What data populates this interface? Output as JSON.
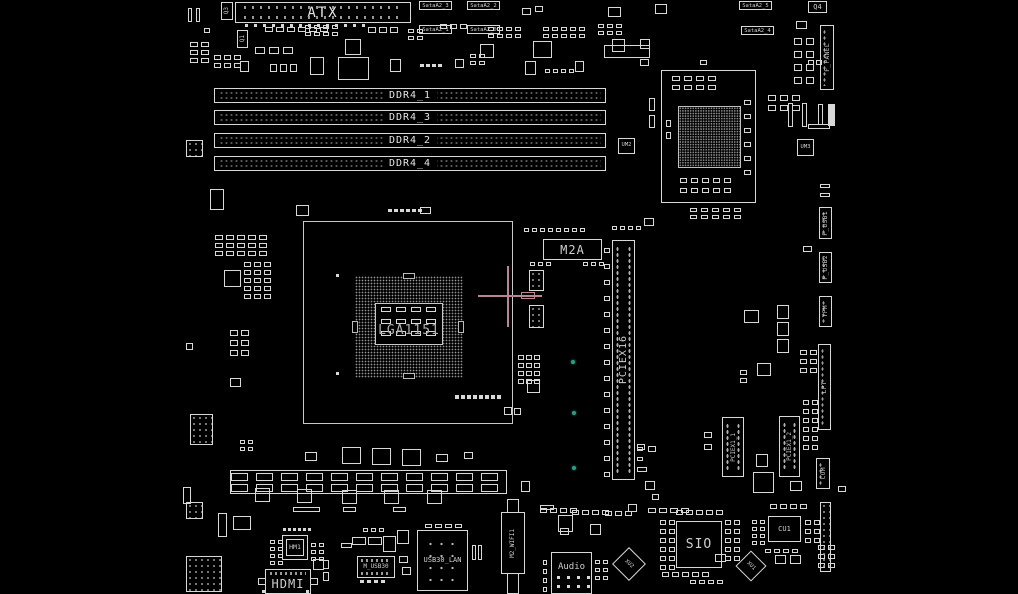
{
  "app": {
    "view": "pcb-boardview",
    "background": "#000000",
    "trace_color": "#d8d8d8",
    "dim_color": "#9a9a9a",
    "label_color": "#cfcfcf",
    "crosshair_color": "#bb8495",
    "testpoint_color": "#2e9a82"
  },
  "labels": {
    "atx": "ATX",
    "cpu_socket": "LGA1151",
    "m2a": "M2A",
    "pciex16": "PCIEX16",
    "pciex1_1": "PCIEX1_1",
    "pciex1_2": "PCIEX1_2",
    "sio": "SIO",
    "audio": "Audio",
    "hdmi": "HDMI",
    "hm1": "HM1",
    "usb30_lan": "USB30_LAN",
    "m_usb30": "M_USB30",
    "m2_wifi": "M2_WIFI1",
    "cu1": "CU1",
    "um2": "UM2",
    "um3": "UM3",
    "q4": "Q4",
    "q3": "Q3",
    "q1": "Q1",
    "xu1": "XU1",
    "xu2": "XU2"
  },
  "ddr_slots": [
    {
      "label": "DDR4_1",
      "y": 88
    },
    {
      "label": "DDR4_3",
      "y": 110
    },
    {
      "label": "DDR4_2",
      "y": 133
    },
    {
      "label": "DDR4_4",
      "y": 156
    }
  ],
  "edge_connectors": [
    {
      "label": "F_PANEL",
      "x": 820,
      "y": 25,
      "w": 14,
      "h": 65
    },
    {
      "label": "F_USB1",
      "x": 819,
      "y": 207,
      "w": 13,
      "h": 32
    },
    {
      "label": "F_USB2",
      "x": 819,
      "y": 252,
      "w": 13,
      "h": 31
    },
    {
      "label": "TPM",
      "x": 819,
      "y": 296,
      "w": 13,
      "h": 31
    },
    {
      "label": "LPT",
      "x": 818,
      "y": 344,
      "w": 13,
      "h": 86
    },
    {
      "label": "COM",
      "x": 816,
      "y": 458,
      "w": 14,
      "h": 31
    }
  ],
  "sata_labels": [
    {
      "text": "SataA2_3",
      "x": 419,
      "y": 1
    },
    {
      "text": "SataA2_2",
      "x": 467,
      "y": 1
    },
    {
      "text": "SataA2_1",
      "x": 419,
      "y": 25
    },
    {
      "text": "SataA2_0",
      "x": 467,
      "y": 25
    },
    {
      "text": "SataA2_5",
      "x": 739,
      "y": 1
    },
    {
      "text": "SataA2_4",
      "x": 741,
      "y": 26
    }
  ],
  "testpoints": [
    {
      "x": 571,
      "y": 360
    },
    {
      "x": 572,
      "y": 411
    },
    {
      "x": 572,
      "y": 466
    }
  ],
  "crosshair": {
    "center_x": 508,
    "center_y": 296
  },
  "clusters": [
    [
      190,
      42,
      2,
      3,
      8,
      5,
      3,
      3
    ],
    [
      188,
      8,
      2,
      1,
      4,
      14,
      4,
      0
    ],
    [
      214,
      55,
      3,
      2,
      7,
      5,
      3,
      3
    ],
    [
      265,
      27,
      6,
      1,
      8,
      5,
      3,
      0
    ],
    [
      305,
      25,
      4,
      2,
      6,
      4,
      3,
      3
    ],
    [
      368,
      27,
      3,
      1,
      8,
      6,
      3,
      0
    ],
    [
      408,
      29,
      2,
      2,
      6,
      4,
      3,
      3
    ],
    [
      440,
      24,
      3,
      1,
      7,
      5,
      3,
      0
    ],
    [
      488,
      27,
      4,
      2,
      6,
      4,
      3,
      3
    ],
    [
      543,
      27,
      5,
      2,
      6,
      4,
      3,
      3
    ],
    [
      598,
      24,
      3,
      2,
      6,
      4,
      3,
      3
    ],
    [
      255,
      47,
      3,
      1,
      10,
      7,
      4,
      0
    ],
    [
      420,
      64,
      4,
      1,
      4,
      3,
      2,
      0
    ],
    [
      470,
      54,
      2,
      2,
      6,
      4,
      3,
      3
    ],
    [
      545,
      69,
      4,
      1,
      5,
      4,
      3,
      0
    ],
    [
      245,
      24,
      14,
      1,
      3,
      3,
      6,
      0
    ],
    [
      215,
      235,
      5,
      3,
      8,
      5,
      3,
      3
    ],
    [
      244,
      262,
      3,
      5,
      7,
      5,
      3,
      3
    ],
    [
      230,
      330,
      2,
      3,
      8,
      6,
      3,
      4
    ],
    [
      240,
      440,
      2,
      2,
      5,
      4,
      3,
      3
    ],
    [
      388,
      209,
      6,
      1,
      4,
      3,
      2,
      0
    ],
    [
      524,
      228,
      8,
      1,
      5,
      4,
      3,
      0
    ],
    [
      530,
      262,
      3,
      1,
      5,
      4,
      3,
      0
    ],
    [
      583,
      262,
      3,
      1,
      5,
      4,
      3,
      0
    ],
    [
      604,
      248,
      1,
      15,
      6,
      5,
      0,
      11
    ],
    [
      518,
      355,
      3,
      4,
      6,
      5,
      2,
      3
    ],
    [
      612,
      226,
      4,
      1,
      5,
      4,
      3,
      0
    ],
    [
      672,
      76,
      4,
      2,
      8,
      5,
      4,
      4
    ],
    [
      744,
      100,
      1,
      6,
      7,
      5,
      0,
      9
    ],
    [
      680,
      178,
      5,
      2,
      7,
      5,
      4,
      5
    ],
    [
      690,
      208,
      5,
      2,
      7,
      4,
      4,
      3
    ],
    [
      768,
      95,
      3,
      2,
      8,
      6,
      4,
      4
    ],
    [
      800,
      350,
      2,
      3,
      7,
      5,
      3,
      4
    ],
    [
      794,
      38,
      2,
      4,
      8,
      7,
      4,
      6
    ],
    [
      818,
      545,
      2,
      3,
      7,
      5,
      3,
      4
    ],
    [
      648,
      508,
      4,
      1,
      8,
      5,
      3,
      0
    ],
    [
      676,
      510,
      5,
      1,
      7,
      5,
      3,
      0
    ],
    [
      660,
      520,
      2,
      6,
      6,
      5,
      3,
      4
    ],
    [
      725,
      520,
      2,
      5,
      6,
      5,
      3,
      4
    ],
    [
      662,
      572,
      5,
      1,
      7,
      5,
      3,
      0
    ],
    [
      690,
      580,
      4,
      1,
      6,
      4,
      3,
      0
    ],
    [
      752,
      520,
      2,
      4,
      5,
      4,
      3,
      3
    ],
    [
      770,
      504,
      4,
      1,
      7,
      5,
      3,
      0
    ],
    [
      805,
      520,
      2,
      3,
      6,
      5,
      3,
      4
    ],
    [
      765,
      549,
      4,
      1,
      6,
      4,
      3,
      0
    ],
    [
      543,
      560,
      1,
      4,
      4,
      5,
      0,
      4
    ],
    [
      595,
      560,
      2,
      3,
      5,
      4,
      3,
      4
    ],
    [
      425,
      524,
      4,
      1,
      7,
      4,
      3,
      0
    ],
    [
      363,
      528,
      3,
      1,
      5,
      4,
      3,
      0
    ],
    [
      270,
      540,
      2,
      4,
      5,
      4,
      3,
      3
    ],
    [
      311,
      543,
      2,
      3,
      5,
      4,
      3,
      3
    ],
    [
      283,
      528,
      6,
      1,
      3,
      3,
      2,
      0
    ],
    [
      704,
      432,
      1,
      2,
      8,
      6,
      0,
      6
    ],
    [
      803,
      400,
      2,
      6,
      6,
      5,
      3,
      4
    ],
    [
      231,
      473,
      11,
      1,
      17,
      8,
      8,
      0
    ],
    [
      231,
      484,
      11,
      1,
      17,
      8,
      8,
      0
    ],
    [
      381,
      307,
      4,
      1,
      10,
      5,
      5,
      0
    ],
    [
      381,
      319,
      4,
      1,
      10,
      5,
      5,
      0
    ],
    [
      381,
      331,
      4,
      1,
      10,
      5,
      5,
      0
    ],
    [
      455,
      395,
      8,
      1,
      4,
      4,
      2,
      0
    ],
    [
      540,
      508,
      4,
      1,
      7,
      5,
      3,
      0
    ],
    [
      572,
      510,
      4,
      1,
      7,
      5,
      3,
      0
    ],
    [
      605,
      511,
      3,
      1,
      7,
      5,
      3,
      0
    ],
    [
      557,
      576,
      4,
      2,
      3,
      3,
      7,
      6
    ],
    [
      360,
      580,
      4,
      1,
      4,
      3,
      3,
      0
    ],
    [
      637,
      447,
      1,
      2,
      6,
      4,
      0,
      6
    ]
  ],
  "parts": [
    [
      345,
      39,
      16,
      16,
      "o"
    ],
    [
      480,
      44,
      14,
      14,
      "o"
    ],
    [
      533,
      41,
      19,
      17,
      "o"
    ],
    [
      604,
      45,
      46,
      13,
      "o"
    ],
    [
      338,
      57,
      31,
      23,
      "o"
    ],
    [
      240,
      61,
      9,
      11,
      "o"
    ],
    [
      270,
      64,
      7,
      8,
      "o"
    ],
    [
      280,
      64,
      7,
      8,
      "o"
    ],
    [
      290,
      64,
      7,
      8,
      "o"
    ],
    [
      310,
      57,
      14,
      18,
      "o"
    ],
    [
      390,
      59,
      11,
      13,
      "o"
    ],
    [
      455,
      59,
      9,
      9,
      "o"
    ],
    [
      525,
      61,
      11,
      14,
      "o"
    ],
    [
      575,
      61,
      9,
      11,
      "o"
    ],
    [
      608,
      7,
      13,
      10,
      "o"
    ],
    [
      655,
      4,
      12,
      10,
      "o"
    ],
    [
      612,
      39,
      13,
      13,
      "o"
    ],
    [
      640,
      39,
      10,
      10,
      "o"
    ],
    [
      186,
      140,
      17,
      17,
      "d"
    ],
    [
      210,
      189,
      14,
      21,
      "o"
    ],
    [
      224,
      270,
      17,
      17,
      "o"
    ],
    [
      190,
      414,
      23,
      31,
      "d"
    ],
    [
      230,
      378,
      11,
      9,
      "o"
    ],
    [
      186,
      343,
      7,
      7,
      "o"
    ],
    [
      342,
      447,
      19,
      17,
      "o"
    ],
    [
      372,
      448,
      19,
      17,
      "o"
    ],
    [
      402,
      449,
      19,
      17,
      "o"
    ],
    [
      305,
      452,
      12,
      9,
      "o"
    ],
    [
      529,
      270,
      15,
      21,
      "d"
    ],
    [
      529,
      305,
      15,
      23,
      "d"
    ],
    [
      527,
      380,
      13,
      13,
      "o"
    ],
    [
      649,
      98,
      6,
      13,
      "o"
    ],
    [
      649,
      115,
      6,
      13,
      "o"
    ],
    [
      788,
      103,
      5,
      24,
      "o"
    ],
    [
      802,
      103,
      5,
      24,
      "o"
    ],
    [
      818,
      104,
      5,
      21,
      "o"
    ],
    [
      808,
      124,
      22,
      5,
      "o"
    ],
    [
      828,
      104,
      7,
      22,
      "f"
    ],
    [
      777,
      305,
      12,
      14,
      "o"
    ],
    [
      777,
      322,
      12,
      14,
      "o"
    ],
    [
      777,
      339,
      12,
      14,
      "o"
    ],
    [
      803,
      246,
      9,
      6,
      "o"
    ],
    [
      820,
      184,
      10,
      4,
      "o"
    ],
    [
      820,
      193,
      10,
      4,
      "o"
    ],
    [
      753,
      472,
      21,
      21,
      "o"
    ],
    [
      756,
      454,
      12,
      13,
      "o"
    ],
    [
      744,
      310,
      15,
      13,
      "o"
    ],
    [
      757,
      363,
      14,
      13,
      "o"
    ],
    [
      740,
      370,
      7,
      5,
      "o"
    ],
    [
      740,
      378,
      7,
      5,
      "o"
    ],
    [
      644,
      218,
      10,
      8,
      "o"
    ],
    [
      186,
      502,
      17,
      17,
      "d"
    ],
    [
      186,
      556,
      36,
      36,
      "d"
    ],
    [
      218,
      513,
      9,
      24,
      "o"
    ],
    [
      233,
      516,
      18,
      14,
      "o"
    ],
    [
      293,
      507,
      27,
      5,
      "o"
    ],
    [
      343,
      507,
      13,
      5,
      "o"
    ],
    [
      393,
      507,
      13,
      5,
      "o"
    ],
    [
      313,
      559,
      11,
      11,
      "o"
    ],
    [
      352,
      537,
      14,
      8,
      "o"
    ],
    [
      368,
      537,
      14,
      8,
      "o"
    ],
    [
      383,
      536,
      13,
      16,
      "o"
    ],
    [
      341,
      543,
      11,
      5,
      "o"
    ],
    [
      399,
      556,
      9,
      7,
      "o"
    ],
    [
      402,
      567,
      9,
      8,
      "o"
    ],
    [
      472,
      545,
      4,
      15,
      "o"
    ],
    [
      478,
      545,
      4,
      15,
      "o"
    ],
    [
      558,
      515,
      15,
      17,
      "o"
    ],
    [
      540,
      505,
      14,
      5,
      "o"
    ],
    [
      560,
      528,
      9,
      7,
      "o"
    ],
    [
      590,
      524,
      11,
      11,
      "o"
    ],
    [
      715,
      554,
      11,
      8,
      "o"
    ],
    [
      775,
      555,
      11,
      9,
      "o"
    ],
    [
      790,
      555,
      11,
      9,
      "o"
    ],
    [
      820,
      502,
      11,
      70,
      "d"
    ],
    [
      296,
      205,
      13,
      11,
      "o"
    ],
    [
      420,
      207,
      11,
      7,
      "o"
    ],
    [
      666,
      120,
      5,
      7,
      "o"
    ],
    [
      666,
      132,
      5,
      7,
      "o"
    ],
    [
      640,
      59,
      9,
      7,
      "o"
    ],
    [
      700,
      60,
      7,
      5,
      "o"
    ],
    [
      796,
      21,
      11,
      8,
      "o"
    ],
    [
      808,
      60,
      6,
      5,
      "o"
    ],
    [
      816,
      60,
      6,
      5,
      "o"
    ],
    [
      183,
      487,
      8,
      17,
      "o"
    ],
    [
      255,
      488,
      15,
      14,
      "o"
    ],
    [
      297,
      489,
      15,
      14,
      "o"
    ],
    [
      342,
      490,
      15,
      14,
      "o"
    ],
    [
      384,
      490,
      15,
      14,
      "o"
    ],
    [
      427,
      490,
      15,
      14,
      "o"
    ],
    [
      436,
      454,
      12,
      8,
      "o"
    ],
    [
      464,
      452,
      9,
      7,
      "o"
    ],
    [
      504,
      407,
      8,
      8,
      "o"
    ],
    [
      514,
      408,
      7,
      7,
      "o"
    ],
    [
      336,
      274,
      3,
      3,
      "f"
    ],
    [
      336,
      372,
      3,
      3,
      "f"
    ],
    [
      521,
      481,
      9,
      11,
      "o"
    ],
    [
      645,
      481,
      10,
      9,
      "o"
    ],
    [
      652,
      494,
      7,
      6,
      "o"
    ],
    [
      790,
      481,
      12,
      10,
      "o"
    ],
    [
      838,
      486,
      8,
      6,
      "o"
    ],
    [
      628,
      504,
      9,
      8,
      "o"
    ],
    [
      323,
      560,
      6,
      9,
      "o"
    ],
    [
      323,
      572,
      6,
      9,
      "o"
    ],
    [
      258,
      578,
      8,
      7,
      "o"
    ],
    [
      310,
      578,
      8,
      7,
      "o"
    ],
    [
      262,
      590,
      3,
      3,
      "f"
    ],
    [
      306,
      590,
      3,
      3,
      "f"
    ],
    [
      397,
      530,
      12,
      14,
      "o"
    ],
    [
      522,
      8,
      9,
      7,
      "o"
    ],
    [
      535,
      6,
      8,
      6,
      "o"
    ],
    [
      204,
      28,
      6,
      5,
      "o"
    ],
    [
      637,
      444,
      8,
      6,
      "o"
    ],
    [
      648,
      446,
      8,
      6,
      "o"
    ],
    [
      637,
      467,
      10,
      5,
      "o"
    ]
  ]
}
